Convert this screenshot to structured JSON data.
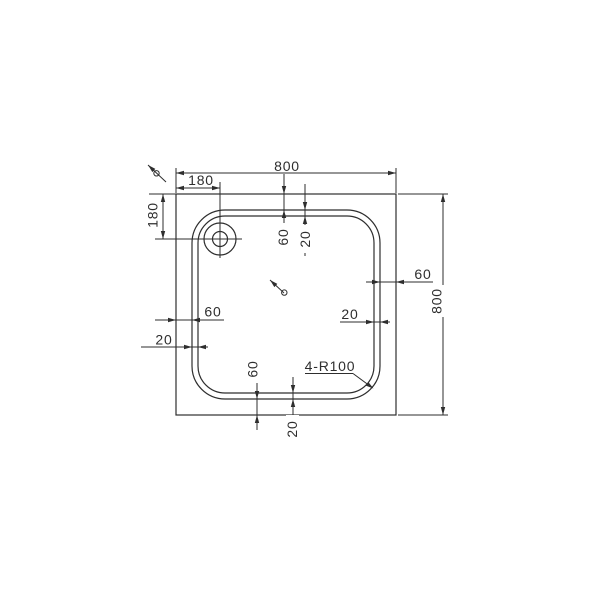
{
  "drawing_labels": {
    "overall_width": "800",
    "overall_height": "800",
    "drain_offset_top": "180",
    "drain_offset_left": "180",
    "rim_width_top": "60",
    "step_width_top": "20",
    "rim_width_left": "60",
    "step_width_left": "20",
    "rim_width_right": "60",
    "step_width_right": "20",
    "rim_width_bottom": "60",
    "step_width_bottom": "20",
    "corner_radius_note": "4-R100"
  },
  "colors": {
    "line": "#2e2e2e",
    "background": "#ffffff"
  }
}
